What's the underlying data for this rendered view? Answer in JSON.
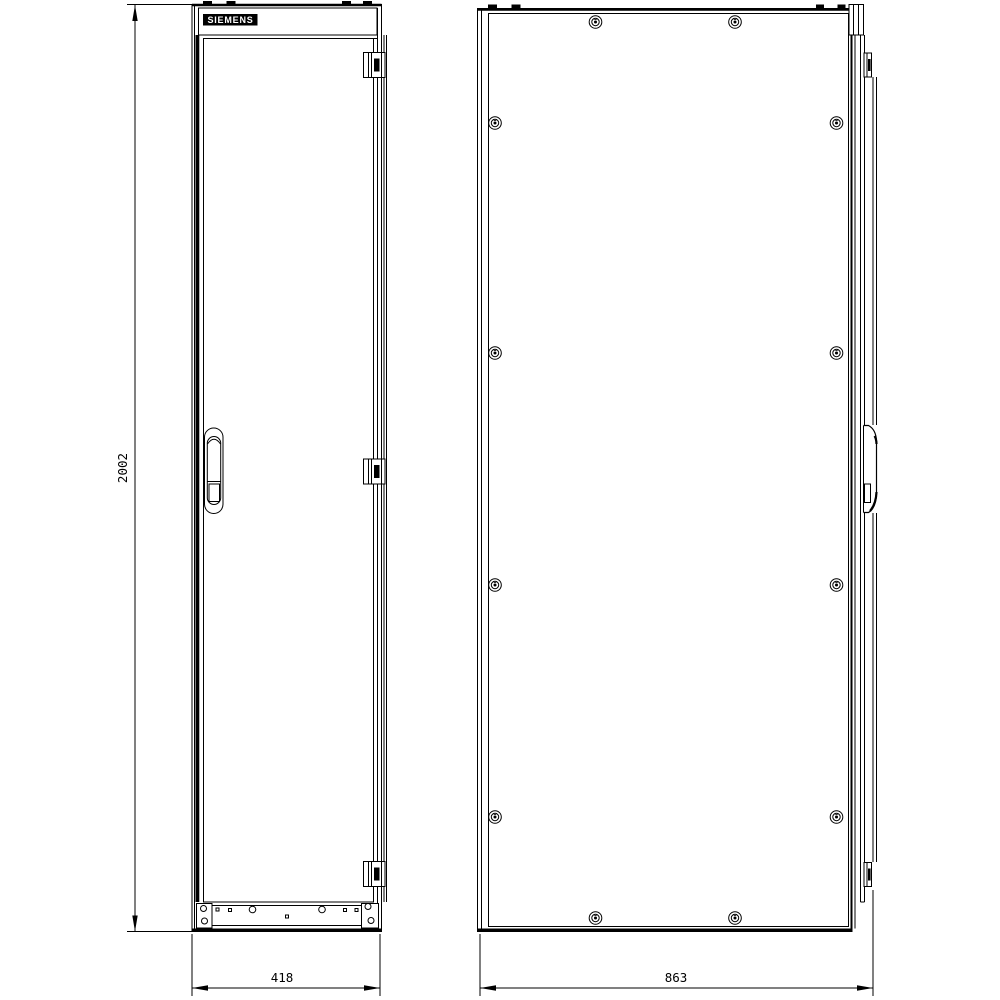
{
  "page": {
    "background": "#ffffff",
    "line_color": "#000000"
  },
  "drawing": {
    "type": "technical-drawing",
    "subject": "electrical-cabinet-enclosure",
    "brand": "SIEMENS",
    "views": [
      {
        "id": "front-view",
        "description": "cabinet front with door, handle, hinges, gland plate"
      },
      {
        "id": "side-view",
        "description": "cabinet side panel with screws and door edge profile"
      }
    ],
    "dimensions": {
      "height_mm": "2002",
      "width_mm": "418",
      "depth_mm": "863"
    }
  }
}
